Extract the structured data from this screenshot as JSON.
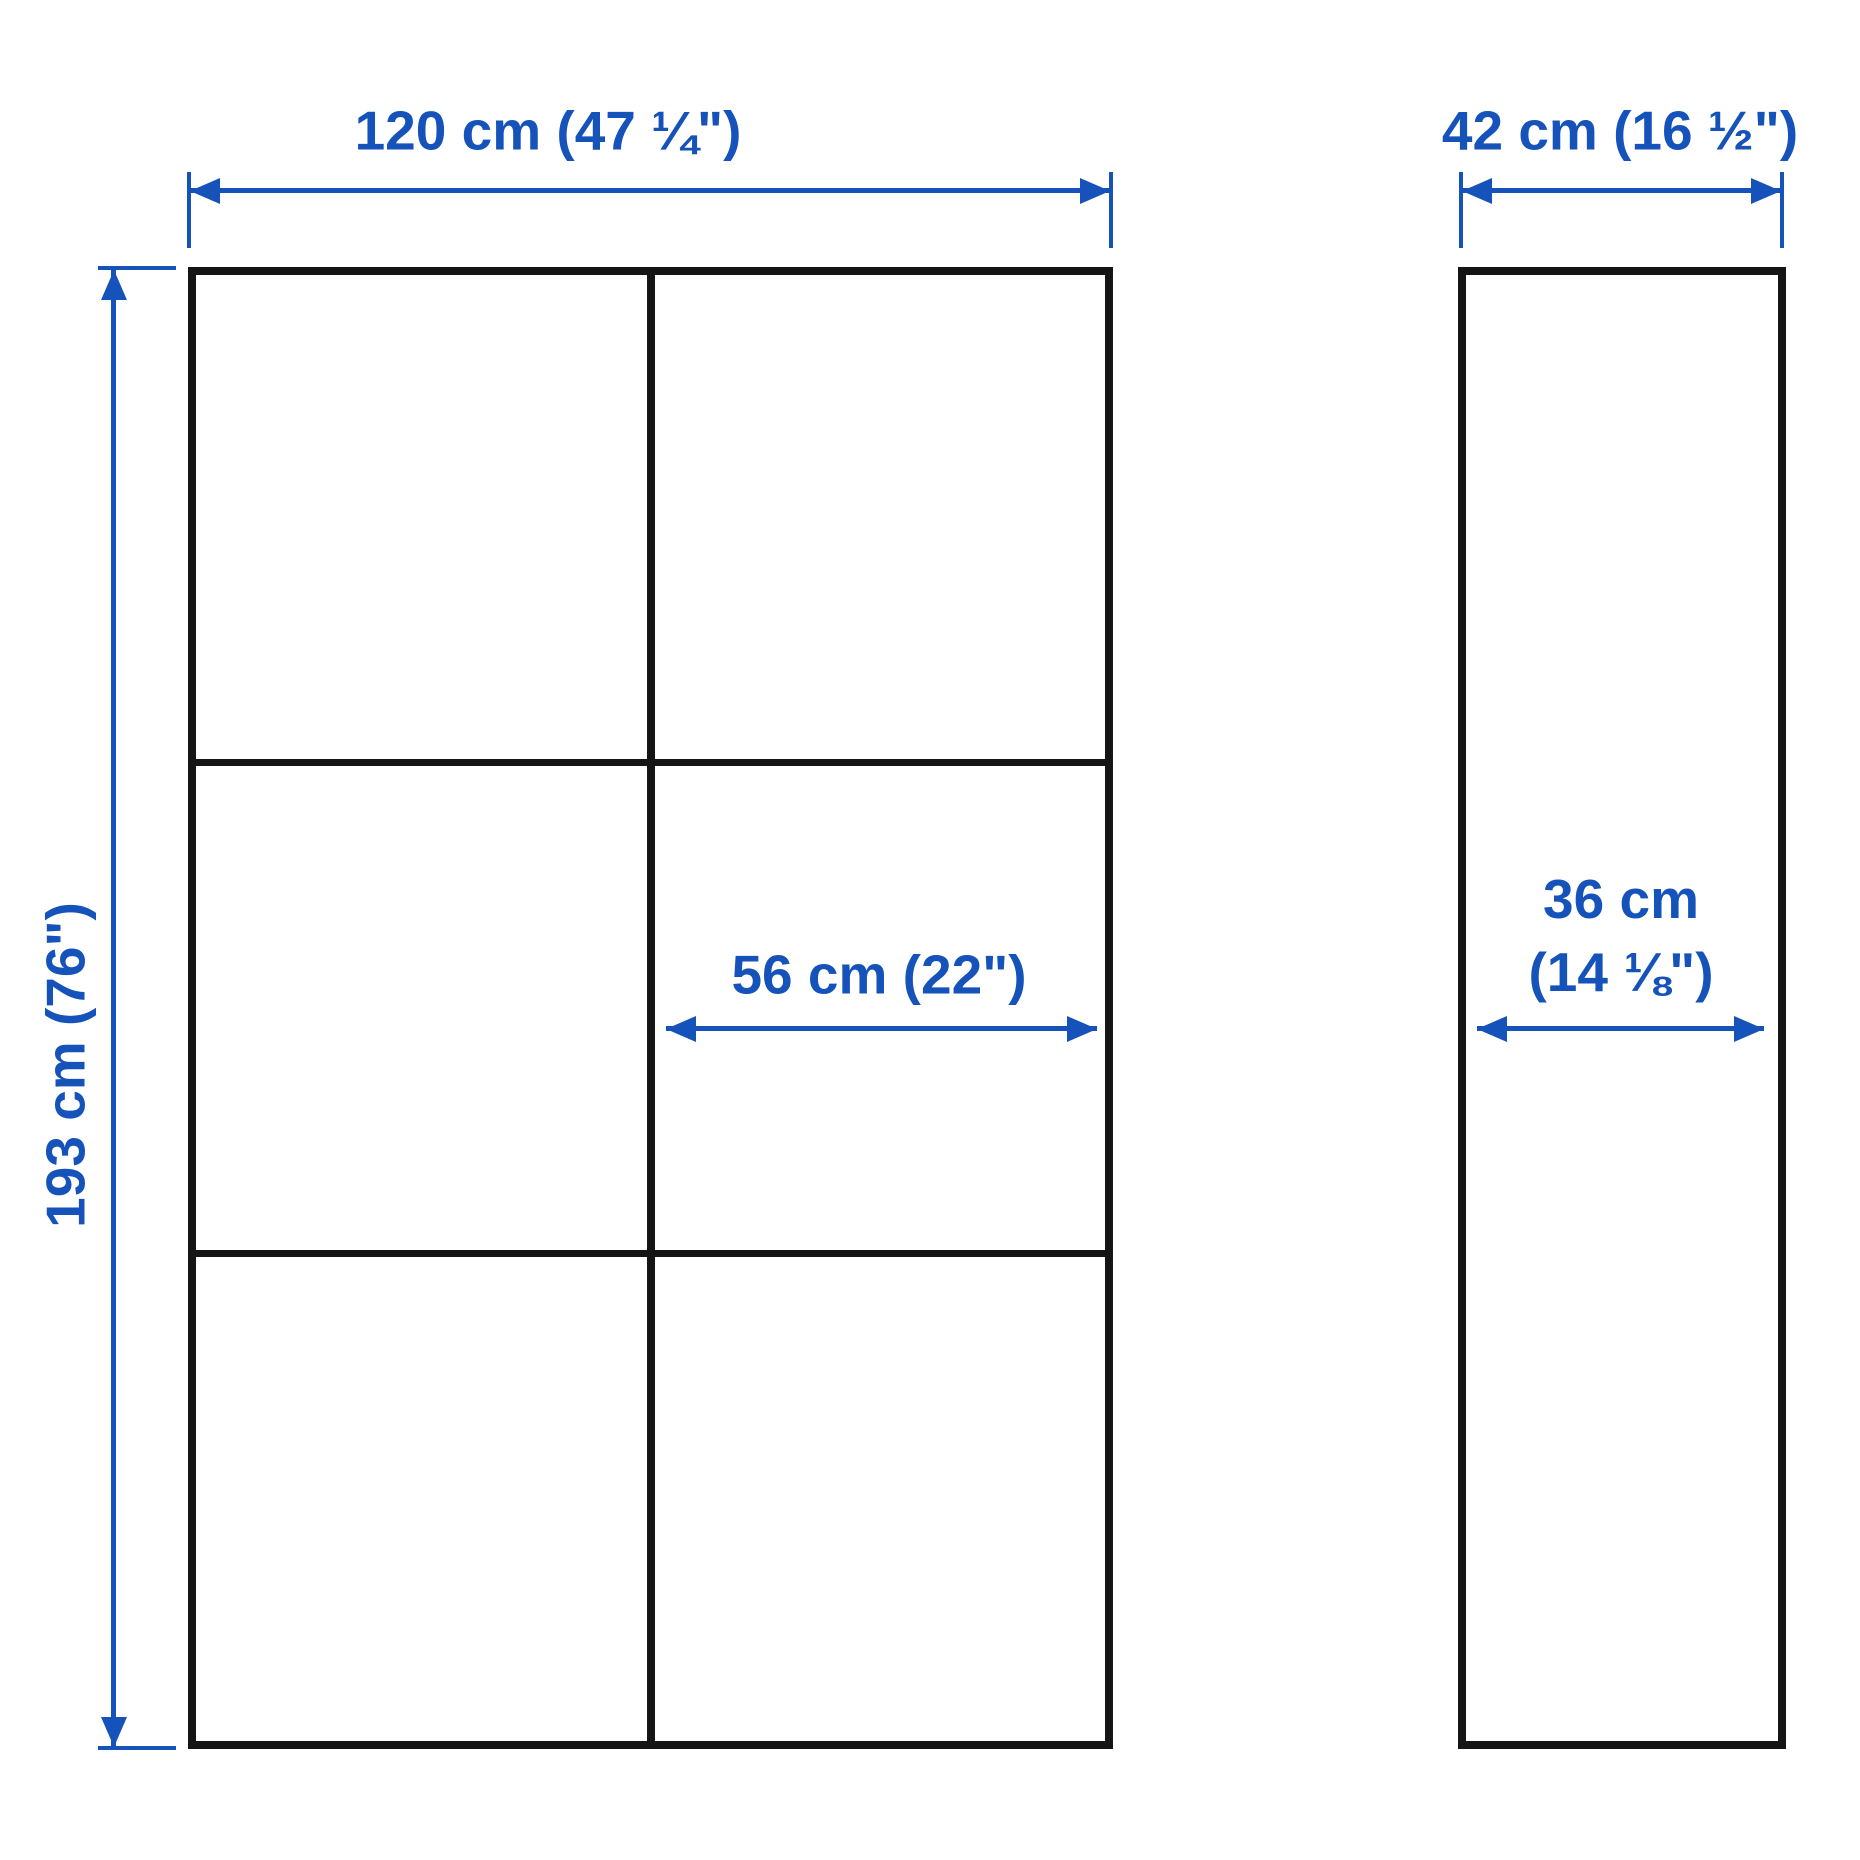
{
  "front_view": {
    "width_label": "120 cm (47 ¼\")",
    "height_label": "193 cm (76\")",
    "compartment_width_label": "56 cm (22\")",
    "columns": 2,
    "rows": 3
  },
  "side_view": {
    "width_label": "42 cm (16 ½\")",
    "depth_label_line1": "36 cm",
    "depth_label_line2": "(14 ⅛\")"
  },
  "measurements": {
    "width_cm": 120,
    "width_in": "47 ¼",
    "height_cm": 193,
    "height_in": "76",
    "compartment_width_cm": 56,
    "compartment_width_in": "22",
    "depth_cm": 42,
    "depth_in": "16 ½",
    "inner_depth_cm": 36,
    "inner_depth_in": "14 ⅛"
  },
  "colors": {
    "accent": "#1552BA",
    "line": "#151515",
    "background": "#FFFFFF"
  }
}
